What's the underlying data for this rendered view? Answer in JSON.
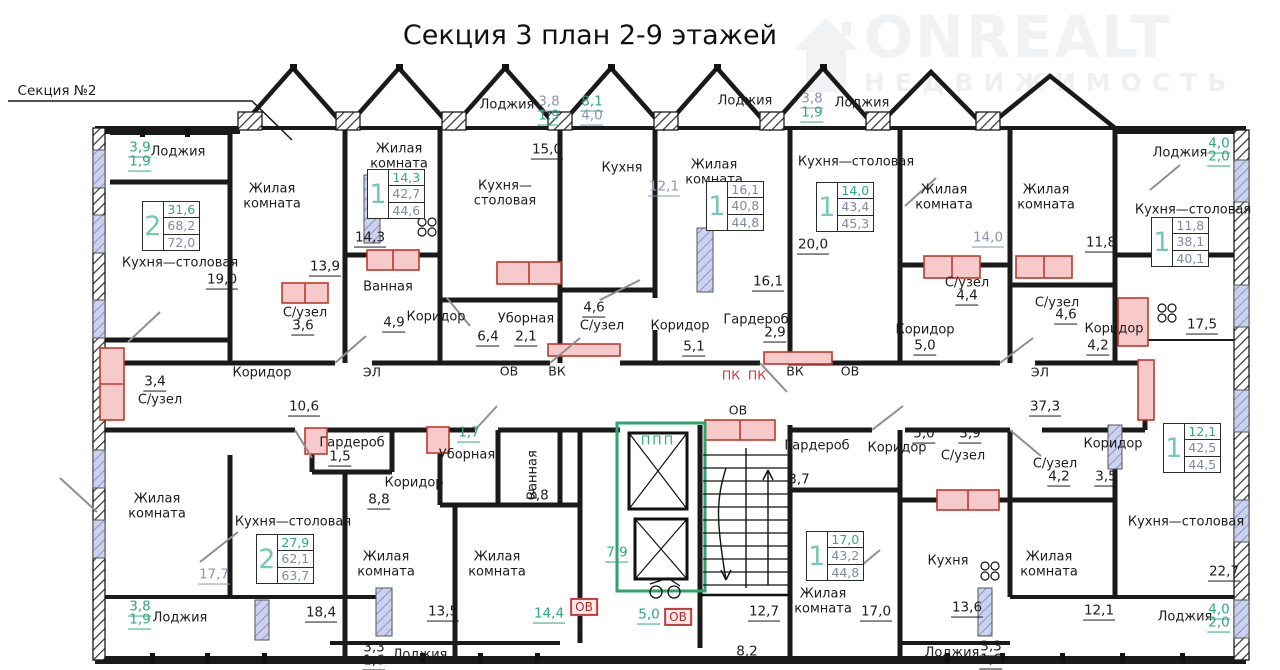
{
  "header": {
    "title": "Секция 3 план 2-9 этажей"
  },
  "logo": {
    "brand": "ONREALT",
    "subtitle": "НЕДВИЖИМОСТЬ",
    "icon": "house-icon"
  },
  "plan": {
    "colors": {
      "wall": "#1a1a1a",
      "green_dim": "#2fa97e",
      "blue_dim": "#8b94b8",
      "red_sanitary": "#c23b3b",
      "teal_digit": "#79c7b6",
      "window": "#c9cfec"
    },
    "labels": [
      {
        "t": "Секция №2",
        "x": 57,
        "y": 92,
        "c": "section",
        "n": "section-2-ref"
      },
      {
        "t": "Лоджия",
        "x": 178,
        "y": 152
      },
      {
        "t": "3,9",
        "x": 140,
        "y": 149,
        "c": "dimg"
      },
      {
        "t": "1,9",
        "x": 140,
        "y": 163,
        "c": "dimg"
      },
      {
        "t": "Жилая\nкомната",
        "x": 272,
        "y": 197
      },
      {
        "t": "Кухня—столовая",
        "x": 180,
        "y": 263
      },
      {
        "t": "19,0",
        "x": 222,
        "y": 281,
        "c": "dim"
      },
      {
        "t": "Жилая\nкомната",
        "x": 399,
        "y": 157
      },
      {
        "t": "14,3",
        "x": 370,
        "y": 239,
        "c": "dim"
      },
      {
        "t": "13,9",
        "x": 325,
        "y": 268,
        "c": "dim"
      },
      {
        "t": "Кухня—\nстоловая",
        "x": 505,
        "y": 194
      },
      {
        "t": "Лоджия",
        "x": 507,
        "y": 105
      },
      {
        "t": "3,8",
        "x": 549,
        "y": 103,
        "c": "dimb"
      },
      {
        "t": "1,9",
        "x": 549,
        "y": 117,
        "c": "dimg"
      },
      {
        "t": "8,1",
        "x": 592,
        "y": 103,
        "c": "dimg"
      },
      {
        "t": "4,0",
        "x": 592,
        "y": 117,
        "c": "dimb"
      },
      {
        "t": "15,0",
        "x": 547,
        "y": 151,
        "c": "dim"
      },
      {
        "t": "Кухня",
        "x": 622,
        "y": 168
      },
      {
        "t": "12,1",
        "x": 664,
        "y": 188,
        "c": "dimb"
      },
      {
        "t": "Лоджия",
        "x": 745,
        "y": 101
      },
      {
        "t": "3,8",
        "x": 812,
        "y": 100,
        "c": "dimb"
      },
      {
        "t": "1,9",
        "x": 812,
        "y": 114,
        "c": "dimg"
      },
      {
        "t": "Лоджия",
        "x": 862,
        "y": 103
      },
      {
        "t": "Жилая\nкомната",
        "x": 714,
        "y": 173
      },
      {
        "t": "Кухня—столовая",
        "x": 856,
        "y": 162
      },
      {
        "t": "20,0",
        "x": 813,
        "y": 246,
        "c": "dim"
      },
      {
        "t": "16,1",
        "x": 768,
        "y": 283,
        "c": "dim"
      },
      {
        "t": "Жилая\nкомната",
        "x": 944,
        "y": 198
      },
      {
        "t": "14,0",
        "x": 988,
        "y": 239,
        "c": "dimb"
      },
      {
        "t": "Жилая\nкомната",
        "x": 1046,
        "y": 198
      },
      {
        "t": "11,8",
        "x": 1101,
        "y": 244,
        "c": "dim"
      },
      {
        "t": "Лоджия",
        "x": 1180,
        "y": 153
      },
      {
        "t": "4,0",
        "x": 1219,
        "y": 145,
        "c": "dimg"
      },
      {
        "t": "2,0",
        "x": 1219,
        "y": 158,
        "c": "dimg"
      },
      {
        "t": "Кухня—столовая",
        "x": 1193,
        "y": 210
      },
      {
        "t": "С/узел",
        "x": 305,
        "y": 313
      },
      {
        "t": "3,6",
        "x": 303,
        "y": 327,
        "c": "dim"
      },
      {
        "t": "Ванная",
        "x": 388,
        "y": 287
      },
      {
        "t": "4,9",
        "x": 394,
        "y": 324,
        "c": "dim"
      },
      {
        "t": "С/узел",
        "x": 160,
        "y": 400
      },
      {
        "t": "3,4",
        "x": 155,
        "y": 383,
        "c": "dim"
      },
      {
        "t": "Коридор",
        "x": 262,
        "y": 373
      },
      {
        "t": "10,6",
        "x": 304,
        "y": 408,
        "c": "dim"
      },
      {
        "t": "Коридор",
        "x": 436,
        "y": 317
      },
      {
        "t": "Уборная",
        "x": 526,
        "y": 319
      },
      {
        "t": "6,4",
        "x": 488,
        "y": 338,
        "c": "dim"
      },
      {
        "t": "2,1",
        "x": 526,
        "y": 338,
        "c": "dim"
      },
      {
        "t": "С/узел",
        "x": 602,
        "y": 326
      },
      {
        "t": "4,6",
        "x": 594,
        "y": 309,
        "c": "dim"
      },
      {
        "t": "Коридор",
        "x": 680,
        "y": 326
      },
      {
        "t": "5,1",
        "x": 694,
        "y": 348,
        "c": "dim"
      },
      {
        "t": "Гардероб",
        "x": 756,
        "y": 320
      },
      {
        "t": "2,9",
        "x": 775,
        "y": 334,
        "c": "dim"
      },
      {
        "t": "С/узел",
        "x": 967,
        "y": 283
      },
      {
        "t": "4,4",
        "x": 967,
        "y": 297,
        "c": "dim"
      },
      {
        "t": "Коридор",
        "x": 925,
        "y": 330
      },
      {
        "t": "5,0",
        "x": 925,
        "y": 347,
        "c": "dim"
      },
      {
        "t": "С/узел",
        "x": 1057,
        "y": 303
      },
      {
        "t": "4,6",
        "x": 1066,
        "y": 316,
        "c": "dim"
      },
      {
        "t": "Коридор",
        "x": 1114,
        "y": 329
      },
      {
        "t": "4,2",
        "x": 1098,
        "y": 347,
        "c": "dim"
      },
      {
        "t": "17,5",
        "x": 1202,
        "y": 326,
        "c": "dim"
      },
      {
        "t": "ЭЛ",
        "x": 372,
        "y": 373,
        "c": "tech"
      },
      {
        "t": "ОВ",
        "x": 509,
        "y": 372,
        "c": "tech"
      },
      {
        "t": "ВК",
        "x": 557,
        "y": 372,
        "c": "tech"
      },
      {
        "t": "ПК",
        "x": 731,
        "y": 376,
        "c": "techred"
      },
      {
        "t": "ПК",
        "x": 757,
        "y": 376,
        "c": "techred"
      },
      {
        "t": "ВК",
        "x": 795,
        "y": 372,
        "c": "tech"
      },
      {
        "t": "ОВ",
        "x": 850,
        "y": 372,
        "c": "tech"
      },
      {
        "t": "ЭЛ",
        "x": 1040,
        "y": 373,
        "c": "tech"
      },
      {
        "t": "37,3",
        "x": 1045,
        "y": 408,
        "c": "dim"
      },
      {
        "t": "Гардероб",
        "x": 352,
        "y": 443
      },
      {
        "t": "1,5",
        "x": 340,
        "y": 458,
        "c": "dim"
      },
      {
        "t": "Уборная",
        "x": 467,
        "y": 455
      },
      {
        "t": "1,7",
        "x": 469,
        "y": 434,
        "c": "dimg"
      },
      {
        "t": "Коридор",
        "x": 414,
        "y": 483
      },
      {
        "t": "8,8",
        "x": 379,
        "y": 501,
        "c": "dim"
      },
      {
        "t": "Ванная",
        "x": 533,
        "y": 475,
        "c": "room vert"
      },
      {
        "t": "3,8",
        "x": 538,
        "y": 497,
        "c": "dim"
      },
      {
        "t": "Кухня—столовая",
        "x": 293,
        "y": 522
      },
      {
        "t": "17,7",
        "x": 214,
        "y": 576,
        "c": "dimb"
      },
      {
        "t": "Жилая\nкомната",
        "x": 157,
        "y": 507
      },
      {
        "t": "Жилая\nкомната",
        "x": 386,
        "y": 565
      },
      {
        "t": "18,4",
        "x": 321,
        "y": 614,
        "c": "dim"
      },
      {
        "t": "Жилая\nкомната",
        "x": 497,
        "y": 565
      },
      {
        "t": "13,5",
        "x": 443,
        "y": 613,
        "c": "dim"
      },
      {
        "t": "Лоджия",
        "x": 180,
        "y": 618
      },
      {
        "t": "3,8",
        "x": 140,
        "y": 608,
        "c": "dimg"
      },
      {
        "t": "1,9",
        "x": 140,
        "y": 621,
        "c": "dimg"
      },
      {
        "t": "Лоджия",
        "x": 420,
        "y": 655
      },
      {
        "t": "3,3",
        "x": 374,
        "y": 649,
        "c": "dim"
      },
      {
        "t": "1,6",
        "x": 374,
        "y": 662,
        "c": "dim"
      },
      {
        "t": "ППП",
        "x": 658,
        "y": 441,
        "c": "ppp"
      },
      {
        "t": "7,9",
        "x": 617,
        "y": 554,
        "c": "dimg"
      },
      {
        "t": "5,0",
        "x": 649,
        "y": 616,
        "c": "dimg"
      },
      {
        "t": "ОВ",
        "x": 584,
        "y": 607,
        "c": "redbox"
      },
      {
        "t": "ОВ",
        "x": 678,
        "y": 617,
        "c": "redbox"
      },
      {
        "t": "14,4",
        "x": 549,
        "y": 615,
        "c": "dimg"
      },
      {
        "t": "ОВ",
        "x": 738,
        "y": 411,
        "c": "tech"
      },
      {
        "t": "12,7",
        "x": 764,
        "y": 613,
        "c": "dim"
      },
      {
        "t": "8,2",
        "x": 747,
        "y": 653,
        "c": "dim"
      },
      {
        "t": "Гардероб",
        "x": 817,
        "y": 446
      },
      {
        "t": "3,7",
        "x": 799,
        "y": 481,
        "c": "dim"
      },
      {
        "t": "Коридор",
        "x": 897,
        "y": 448
      },
      {
        "t": "5,0",
        "x": 924,
        "y": 435,
        "c": "dim"
      },
      {
        "t": "С/узел",
        "x": 963,
        "y": 456
      },
      {
        "t": "3,9",
        "x": 970,
        "y": 435,
        "c": "dim"
      },
      {
        "t": "С/узел",
        "x": 1055,
        "y": 464
      },
      {
        "t": "4,2",
        "x": 1059,
        "y": 478,
        "c": "dim"
      },
      {
        "t": "Коридор",
        "x": 1113,
        "y": 444
      },
      {
        "t": "3,5",
        "x": 1106,
        "y": 478,
        "c": "dim"
      },
      {
        "t": "Жилая\nкомната",
        "x": 823,
        "y": 602
      },
      {
        "t": "17,0",
        "x": 876,
        "y": 613,
        "c": "dim"
      },
      {
        "t": "Кухня",
        "x": 948,
        "y": 561
      },
      {
        "t": "13,6",
        "x": 967,
        "y": 609,
        "c": "dim"
      },
      {
        "t": "Жилая\nкомната",
        "x": 1049,
        "y": 565
      },
      {
        "t": "12,1",
        "x": 1099,
        "y": 612,
        "c": "dim"
      },
      {
        "t": "Кухня—столовая",
        "x": 1186,
        "y": 522
      },
      {
        "t": "22,7",
        "x": 1224,
        "y": 573,
        "c": "dim"
      },
      {
        "t": "Лоджия",
        "x": 952,
        "y": 653
      },
      {
        "t": "3,3",
        "x": 991,
        "y": 648,
        "c": "dim"
      },
      {
        "t": "1,6",
        "x": 991,
        "y": 661,
        "c": "dim"
      },
      {
        "t": "Лоджия",
        "x": 1185,
        "y": 617
      },
      {
        "t": "4,0",
        "x": 1219,
        "y": 611,
        "c": "dimg"
      },
      {
        "t": "2,0",
        "x": 1219,
        "y": 624,
        "c": "dimg"
      }
    ],
    "apartments": [
      {
        "x": 171,
        "y": 226,
        "digit": "2",
        "v1": "31,6",
        "v2": "68,2",
        "v3": "72,0",
        "v1_green": true
      },
      {
        "x": 396,
        "y": 194,
        "digit": "1",
        "v1": "14,3",
        "v2": "42,7",
        "v3": "44,6",
        "v1_green": true
      },
      {
        "x": 735,
        "y": 206,
        "digit": "1",
        "v1": "16,1",
        "v2": "40,8",
        "v3": "44,8",
        "v1_green": false
      },
      {
        "x": 845,
        "y": 207,
        "digit": "1",
        "v1": "14,0",
        "v2": "43,4",
        "v3": "45,3",
        "v1_green": true
      },
      {
        "x": 1180,
        "y": 242,
        "digit": "1",
        "v1": "11,8",
        "v2": "38,1",
        "v3": "40,1",
        "v1_green": false
      },
      {
        "x": 285,
        "y": 559,
        "digit": "2",
        "v1": "27,9",
        "v2": "62,1",
        "v3": "63,7",
        "v1_green": true
      },
      {
        "x": 835,
        "y": 556,
        "digit": "1",
        "v1": "17,0",
        "v2": "43,2",
        "v3": "44,8",
        "v1_green": true
      },
      {
        "x": 1192,
        "y": 448,
        "digit": "1",
        "v1": "12,1",
        "v2": "42,5",
        "v3": "44,5",
        "v1_green": true
      }
    ]
  }
}
